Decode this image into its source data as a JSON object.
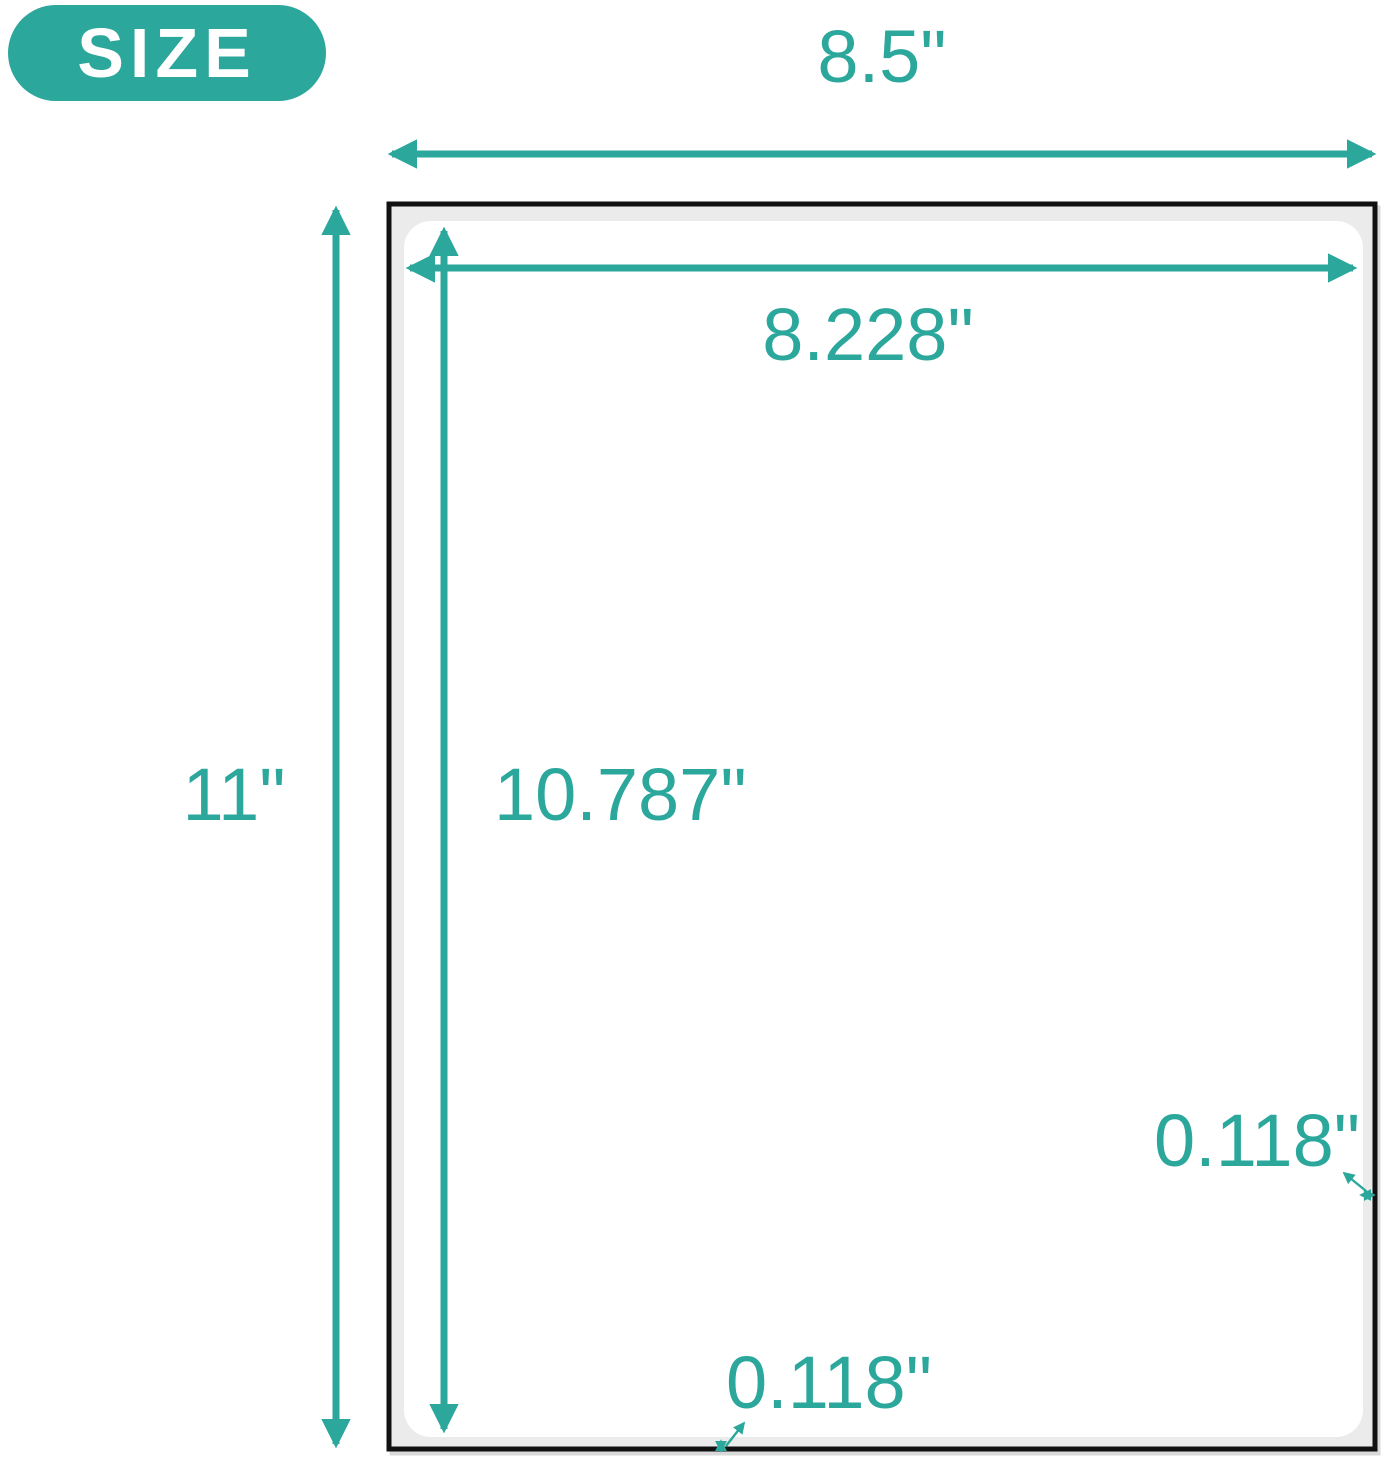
{
  "badge": {
    "label": "SIZE"
  },
  "colors": {
    "accent": "#2BA79C",
    "page_fill": "#EBEBEB",
    "page_border": "#111111",
    "label_fill": "#FFFFFF",
    "badge_text": "#FFFFFF"
  },
  "diagram": {
    "sheet_width_label": "8.5\"",
    "sheet_height_label": "11\"",
    "label_width_label": "8.228\"",
    "label_height_label": "10.787\"",
    "right_margin_label": "0.118\"",
    "bottom_margin_label": "0.118\""
  }
}
